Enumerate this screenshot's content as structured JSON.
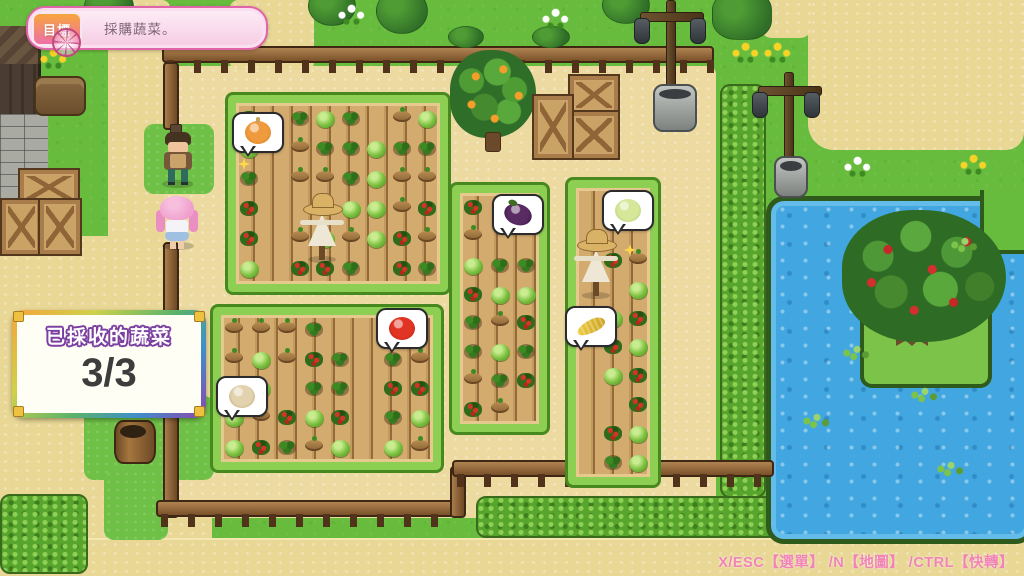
{
  "hud": {
    "goal": {
      "label": "目標",
      "text": "採購蔬菜。"
    },
    "harvest_panel": {
      "title": "已採收的蔬菜",
      "count": "3/3"
    },
    "controls_hint": "X/ESC【選單】 /N【地圖】 /CTRL【快轉】"
  },
  "bubbles": [
    {
      "vegetable": "onion",
      "color": "#f09a3e",
      "accent": "#cf7a1e"
    },
    {
      "vegetable": "eggplant",
      "color": "#5a2a63",
      "accent": "#321239"
    },
    {
      "vegetable": "cabbage",
      "color": "#d7e79a",
      "accent": "#a9c868"
    },
    {
      "vegetable": "tomato",
      "color": "#e23424",
      "accent": "#a91f12"
    },
    {
      "vegetable": "corn",
      "color": "#f2d041",
      "accent": "#c99f22"
    },
    {
      "vegetable": "garlic",
      "color": "#e2d2ae",
      "accent": "#b49c72"
    }
  ],
  "colors": {
    "hud_pink": "#f184b5",
    "banner_border": "#df64a8",
    "badge_gradient_top": "#f7a63e",
    "badge_gradient_bottom": "#ee6fa8",
    "panel_title_outline": "#7b3fa0",
    "water": "#42a7e0",
    "grass": "#67bb3d",
    "path_sand": "#e9d795"
  }
}
